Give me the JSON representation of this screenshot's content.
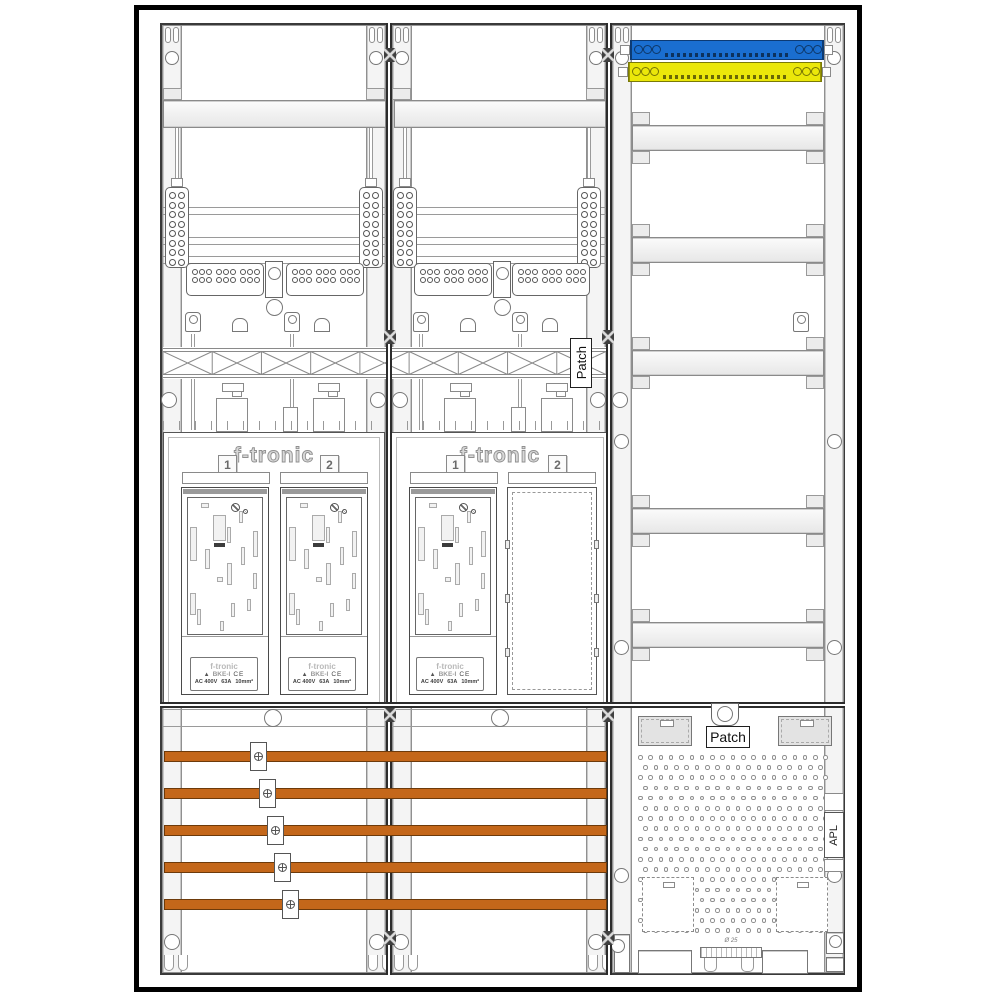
{
  "colors": {
    "blue": "#1a6ed0",
    "yellow": "#ebe70a",
    "busbar": "#c4671a"
  },
  "panels": {
    "panel1": {
      "brand": "f-tronic",
      "slot1": "1",
      "slot2": "2"
    },
    "panel2": {
      "brand": "f-tronic",
      "slot1": "1",
      "slot2": "2"
    }
  },
  "meter_label": {
    "brand": "f-tronic",
    "logo": "▲",
    "model": "BKE-I",
    "ce": "CE",
    "voltage": "AC 400V",
    "current": "63A",
    "wire": "10mm²"
  },
  "labels": {
    "patch_side": "Patch",
    "patch_bottom": "Patch",
    "apl": "APL",
    "diameter": "Ø 25"
  }
}
